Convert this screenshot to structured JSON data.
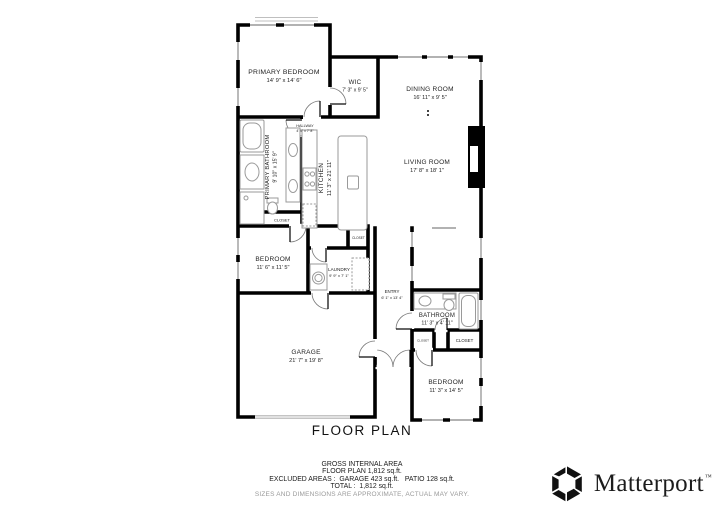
{
  "plan": {
    "title": "FLOOR PLAN",
    "rooms": {
      "primary_bedroom": {
        "name": "PRIMARY BEDROOM",
        "dims": "14' 9\" x 14' 6\""
      },
      "wic": {
        "name": "WIC",
        "dims": "7' 3\" x 9' 5\""
      },
      "dining_room": {
        "name": "DINING ROOM",
        "dims": "16' 11\" x 9' 5\""
      },
      "living_room": {
        "name": "LIVING ROOM",
        "dims": "17' 8\" x 18' 1\""
      },
      "kitchen": {
        "name": "KITCHEN",
        "dims": "11' 3\" x 21' 11\""
      },
      "primary_bathroom": {
        "name": "PRIMARY BATHROOM",
        "dims": "9' 10\" x 15' 9\""
      },
      "hallway": {
        "name": "HALLWAY",
        "dims": "4' 9\" x 7' 8\""
      },
      "closet_hall": {
        "name": "CLOSET"
      },
      "bedroom_2": {
        "name": "BEDROOM",
        "dims": "11' 6\" x 11' 5\""
      },
      "laundry": {
        "name": "LAUNDRY",
        "dims": "9' 9\" x 7' 1\""
      },
      "closet_laundry": {
        "name": "CLOSET"
      },
      "entry": {
        "name": "ENTRY",
        "dims": "6' 1\" x 13' 4\""
      },
      "bathroom_2": {
        "name": "BATHROOM",
        "dims": "11' 3\" x 4' 11\""
      },
      "closet_small": {
        "name": "CLOSET"
      },
      "closet_bedroom_3": {
        "name": "CLOSET"
      },
      "bedroom_3": {
        "name": "BEDROOM",
        "dims": "11' 3\" x 14' 5\""
      },
      "garage": {
        "name": "GARAGE",
        "dims": "21' 7\" x 19' 8\""
      }
    }
  },
  "footer": {
    "line1": "GROSS INTERNAL AREA",
    "line2": "FLOOR PLAN 1,812 sq.ft.",
    "line3": "EXCLUDED AREAS :  GARAGE 423 sq.ft.   PATIO 128 sq.ft.",
    "line4": "TOTAL :  1,812 sq.ft.",
    "note": "SIZES AND DIMENSIONS ARE APPROXIMATE, ACTUAL MAY VARY."
  },
  "branding": {
    "logo_text": "Matterport",
    "trademark": "™"
  },
  "colors": {
    "wall": "#000000",
    "fixture": "#9a9a9a",
    "note_text": "#9a9a9a"
  }
}
